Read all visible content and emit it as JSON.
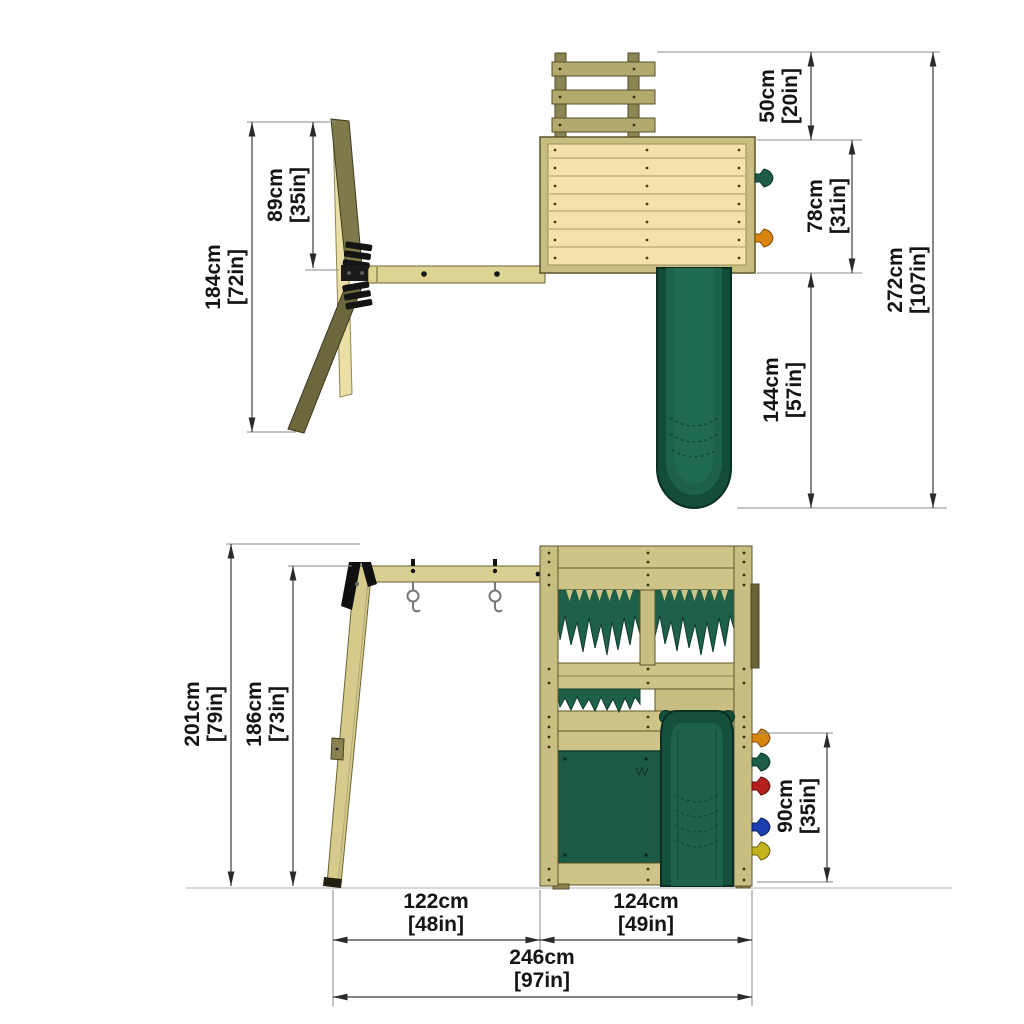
{
  "colors": {
    "background": "#ffffff",
    "wood_deck": "#f3e2ab",
    "wood_plank": "#cfc488",
    "wood_beam": "#d9cf92",
    "wood_olive_leg": "#7f7a49",
    "wood_dark_leg": "#6c673c",
    "green_fringe": "#1e6049",
    "green_panel": "#1c5a43",
    "green_slide": "#15503d",
    "hold_orange": "#d8860f",
    "hold_green": "#1d5c47",
    "hold_red": "#b5201d",
    "hold_blue": "#1a3fae",
    "hold_yellow": "#c3b41e",
    "dimension_line": "#3c3c3c",
    "label_text": "#141414"
  },
  "top_view": {
    "dimensions": {
      "arm_span": {
        "cm": "89cm",
        "inch": "[35in]"
      },
      "frame_depth": {
        "cm": "184cm",
        "inch": "[72in]"
      },
      "ladder_depth": {
        "cm": "50cm",
        "inch": "[20in]"
      },
      "platform_depth": {
        "cm": "78cm",
        "inch": "[31in]"
      },
      "slide_length": {
        "cm": "144cm",
        "inch": "[57in]"
      },
      "total_depth": {
        "cm": "272cm",
        "inch": "[107in]"
      }
    }
  },
  "front_view": {
    "dimensions": {
      "total_height": {
        "cm": "201cm",
        "inch": "[79in]"
      },
      "beam_height": {
        "cm": "186cm",
        "inch": "[73in]"
      },
      "wall_height": {
        "cm": "90cm",
        "inch": "[35in]"
      },
      "swing_span": {
        "cm": "122cm",
        "inch": "[48in]"
      },
      "tower_span": {
        "cm": "124cm",
        "inch": "[49in]"
      },
      "total_width": {
        "cm": "246cm",
        "inch": "[97in]"
      }
    }
  }
}
